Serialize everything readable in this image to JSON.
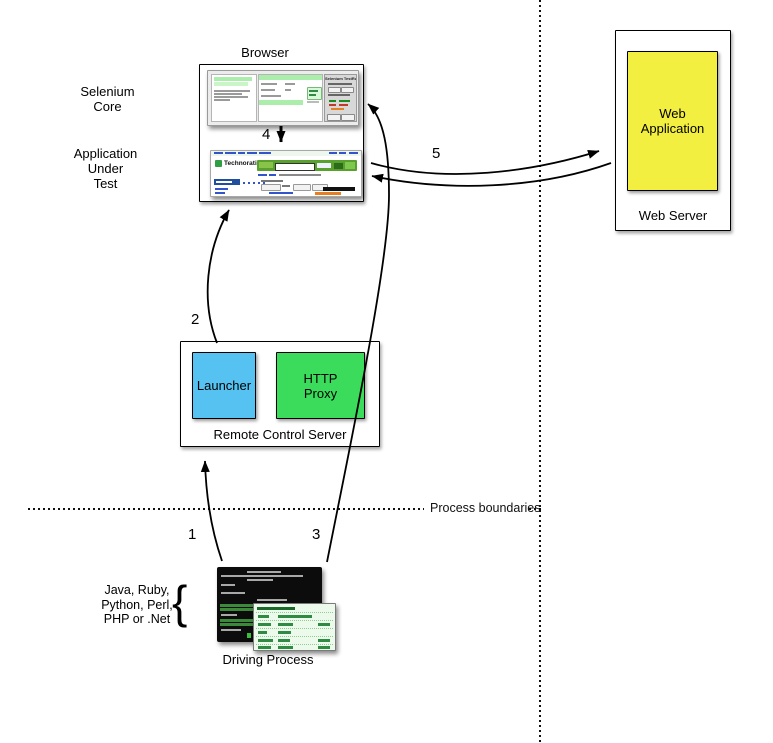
{
  "labels": {
    "browser": "Browser",
    "selenium_core": "Selenium\nCore",
    "application_under_test": "Application\nUnder\nTest",
    "web_application": "Web\nApplication",
    "web_server": "Web Server",
    "launcher": "Launcher",
    "http_proxy": "HTTP\nProxy",
    "remote_control_server": "Remote Control Server",
    "process_boundaries": "Process boundaries",
    "driving_process": "Driving Process",
    "languages": "Java, Ruby,\nPython, Perl,\nPHP or .Net",
    "brace": "{"
  },
  "steps": {
    "s1": "1",
    "s2": "2",
    "s3": "3",
    "s4": "4",
    "s5": "5"
  },
  "screenshots": {
    "testrunner_title": "Selenium TestRunner",
    "technorati_logo": "Technorati"
  },
  "colors": {
    "web_application_fill": "#f3ef40",
    "launcher_fill": "#55c2f1",
    "http_proxy_fill": "#3bdb5b",
    "technorati_green": "#57a12c",
    "selenium_row_green": "#abeeab",
    "terminal_bg": "#0c0c0c",
    "result_table_bg": "#ecfaec"
  }
}
